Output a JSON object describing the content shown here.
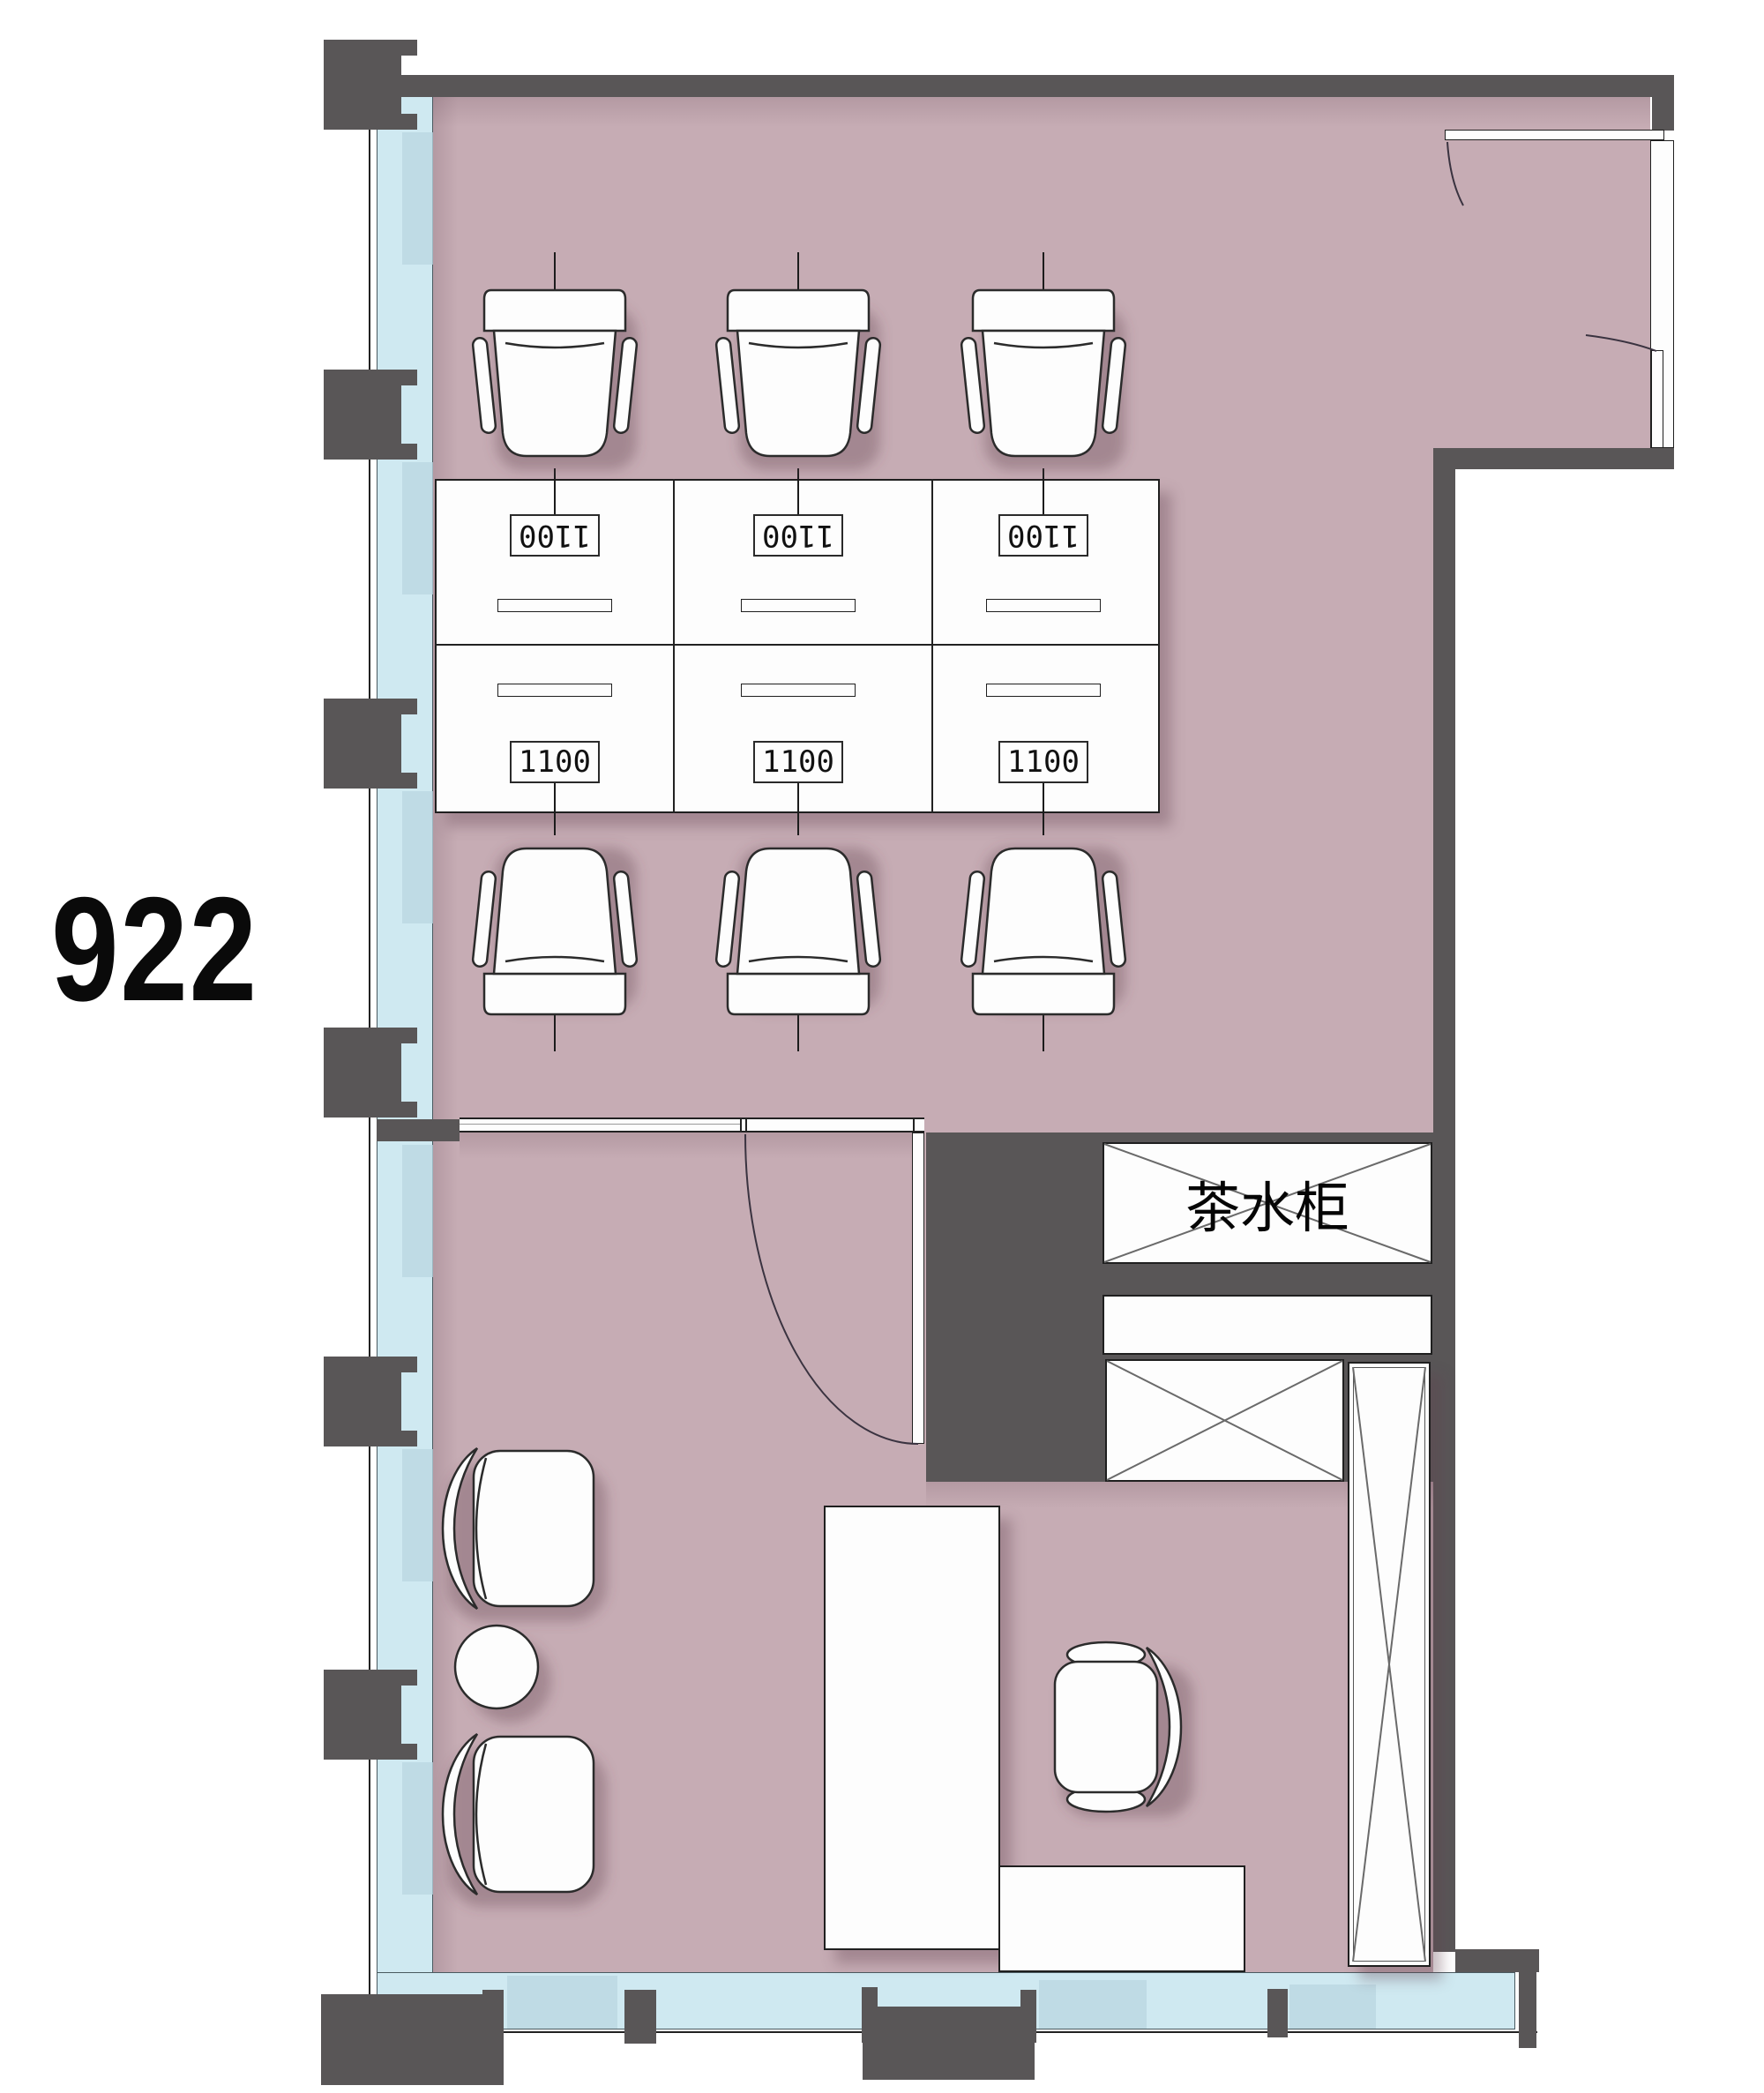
{
  "room": {
    "number": "922"
  },
  "workstations": {
    "size_label": "1100",
    "rows": [
      {
        "orientation": "rotated-180",
        "labels": [
          "1100",
          "1100",
          "1100"
        ]
      },
      {
        "orientation": "upright",
        "labels": [
          "1100",
          "1100",
          "1100"
        ]
      }
    ]
  },
  "casework": {
    "tea_cabinet_label": "茶水柜"
  },
  "colors": {
    "floor": "#c6acb4",
    "glazing": "#cfe9f1",
    "glazing_shaded": "#b9d6e0",
    "wall": "#595657",
    "furniture_fill": "#fdfdfd",
    "outline": "#1f1f1f",
    "text": "#0a0a0a"
  }
}
